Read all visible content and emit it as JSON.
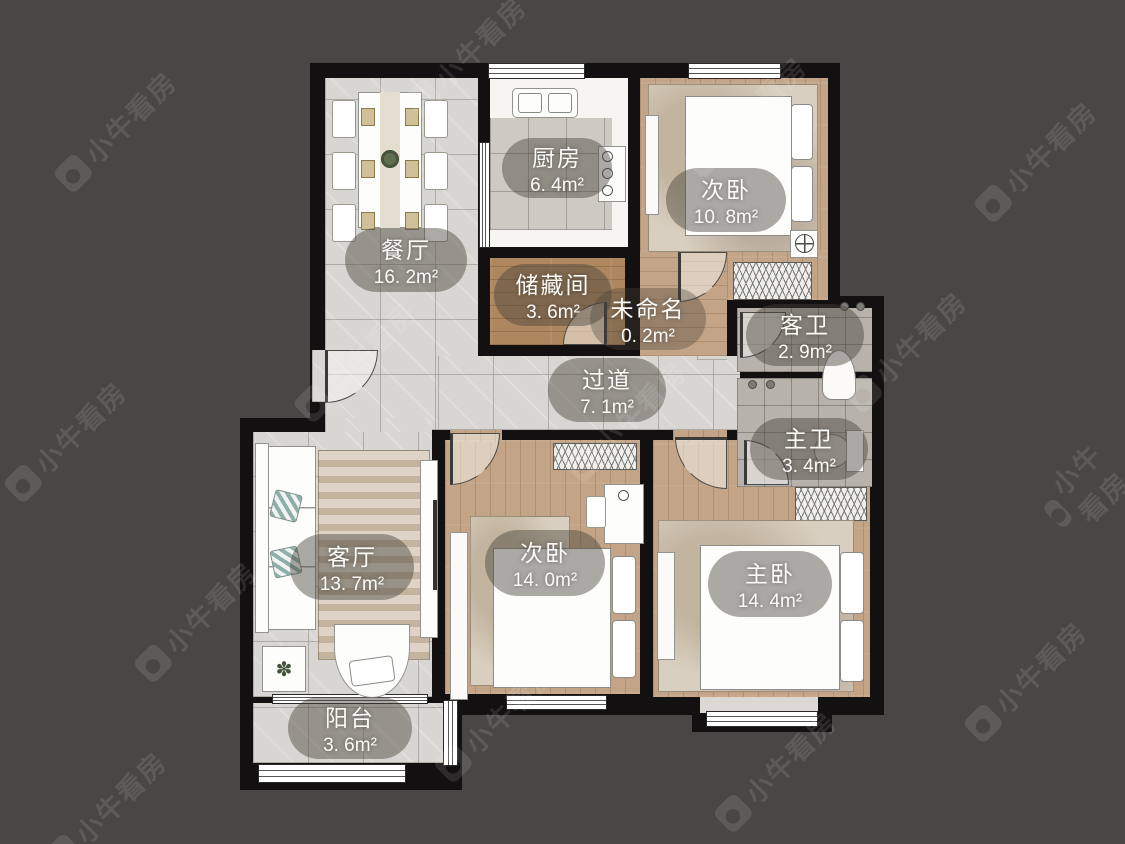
{
  "meta": {
    "watermark_text": "小牛看房"
  },
  "palette": {
    "background": "#494646",
    "wall": "#121010",
    "tile_floor": "#d8d6d2",
    "wood_floor": "#c3a486",
    "storage_wood": "#ae875f",
    "bath_tile": "#b7b3ac",
    "kitchen_floor": "#f6f5f2",
    "label_bubble": "rgba(72,66,58,0.45)",
    "label_text": "#fafaf7"
  },
  "icons": {
    "plant": "✽"
  },
  "rooms": [
    {
      "id": "dining",
      "name": "餐厅",
      "area": "16. 2m²"
    },
    {
      "id": "kitchen",
      "name": "厨房",
      "area": "6. 4m²"
    },
    {
      "id": "bedroom2-top",
      "name": "次卧",
      "area": "10. 8m²"
    },
    {
      "id": "storage",
      "name": "储藏间",
      "area": "3. 6m²"
    },
    {
      "id": "unnamed",
      "name": "未命名",
      "area": "0. 2m²"
    },
    {
      "id": "guest-bath",
      "name": "客卫",
      "area": "2. 9m²"
    },
    {
      "id": "hallway",
      "name": "过道",
      "area": "7. 1m²"
    },
    {
      "id": "master-bath",
      "name": "主卫",
      "area": "3. 4m²"
    },
    {
      "id": "living",
      "name": "客厅",
      "area": "13. 7m²"
    },
    {
      "id": "bedroom2-bottom",
      "name": "次卧",
      "area": "14. 0m²"
    },
    {
      "id": "master-bedroom",
      "name": "主卧",
      "area": "14. 4m²"
    },
    {
      "id": "balcony",
      "name": "阳台",
      "area": "3. 6m²"
    }
  ]
}
